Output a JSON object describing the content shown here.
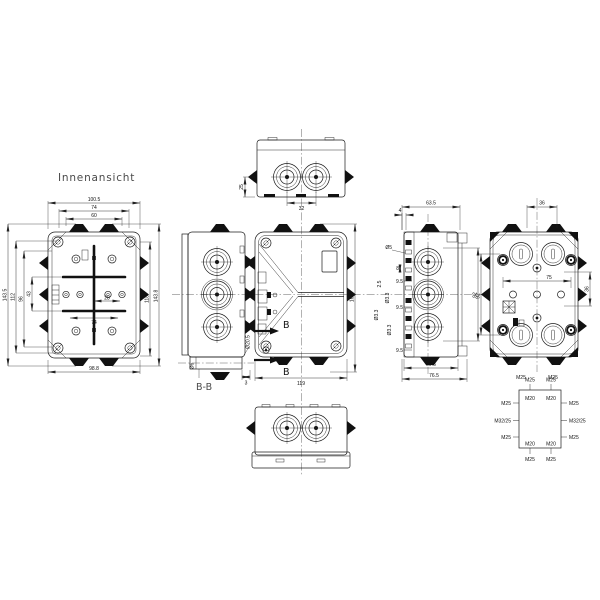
{
  "title": "Innenansicht",
  "inner_view": {
    "dim_top_outer": "100.5",
    "dim_top_mid": "74",
    "dim_top_inner": "60",
    "dim_left_outer": "143.5",
    "dim_left_2": "112",
    "dim_left_3": "96",
    "dim_left_inner": "43",
    "dim_right_inner": "118",
    "dim_right_outer": "143.8",
    "dim_bottom": "98.8",
    "dim_center_small": "28",
    "dim_center_low": "74"
  },
  "top_view": {
    "dim_depth": "25",
    "dim_gland_spacing": "32"
  },
  "section_view": {
    "caption": "B-B",
    "dim_hole": "Ø6",
    "dim_boss": "Ø20.5",
    "dim_lip": "3"
  },
  "front_view": {
    "dim_width": "119",
    "dim_height": "164",
    "section_marker": "B"
  },
  "side_view": {
    "dim_depth": "63.5",
    "dim_lid": "4",
    "chain": [
      "Ø5",
      "8",
      "9.5",
      "2.5",
      "Ø3.3",
      "9.5",
      "Ø3.3",
      "Ø3.3",
      "9.5"
    ],
    "dim_bottom_inner": "59.5",
    "dim_bottom_outer": "76.5",
    "dim_right": "92"
  },
  "back_view": {
    "dim_top": "36",
    "dim_center": "75",
    "dim_left": "92",
    "dim_right": "36",
    "bottom_labels": [
      "M25",
      "M25"
    ]
  },
  "gland_diagram": {
    "top_outer": [
      "M25",
      "M25"
    ],
    "top_inner": [
      "M20",
      "M20"
    ],
    "left": [
      "M25",
      "M32/25",
      "M25"
    ],
    "right": [
      "M25",
      "M32/25",
      "M25"
    ],
    "bottom_inner": [
      "M20",
      "M20"
    ],
    "bottom_outer": [
      "M25",
      "M25"
    ]
  }
}
